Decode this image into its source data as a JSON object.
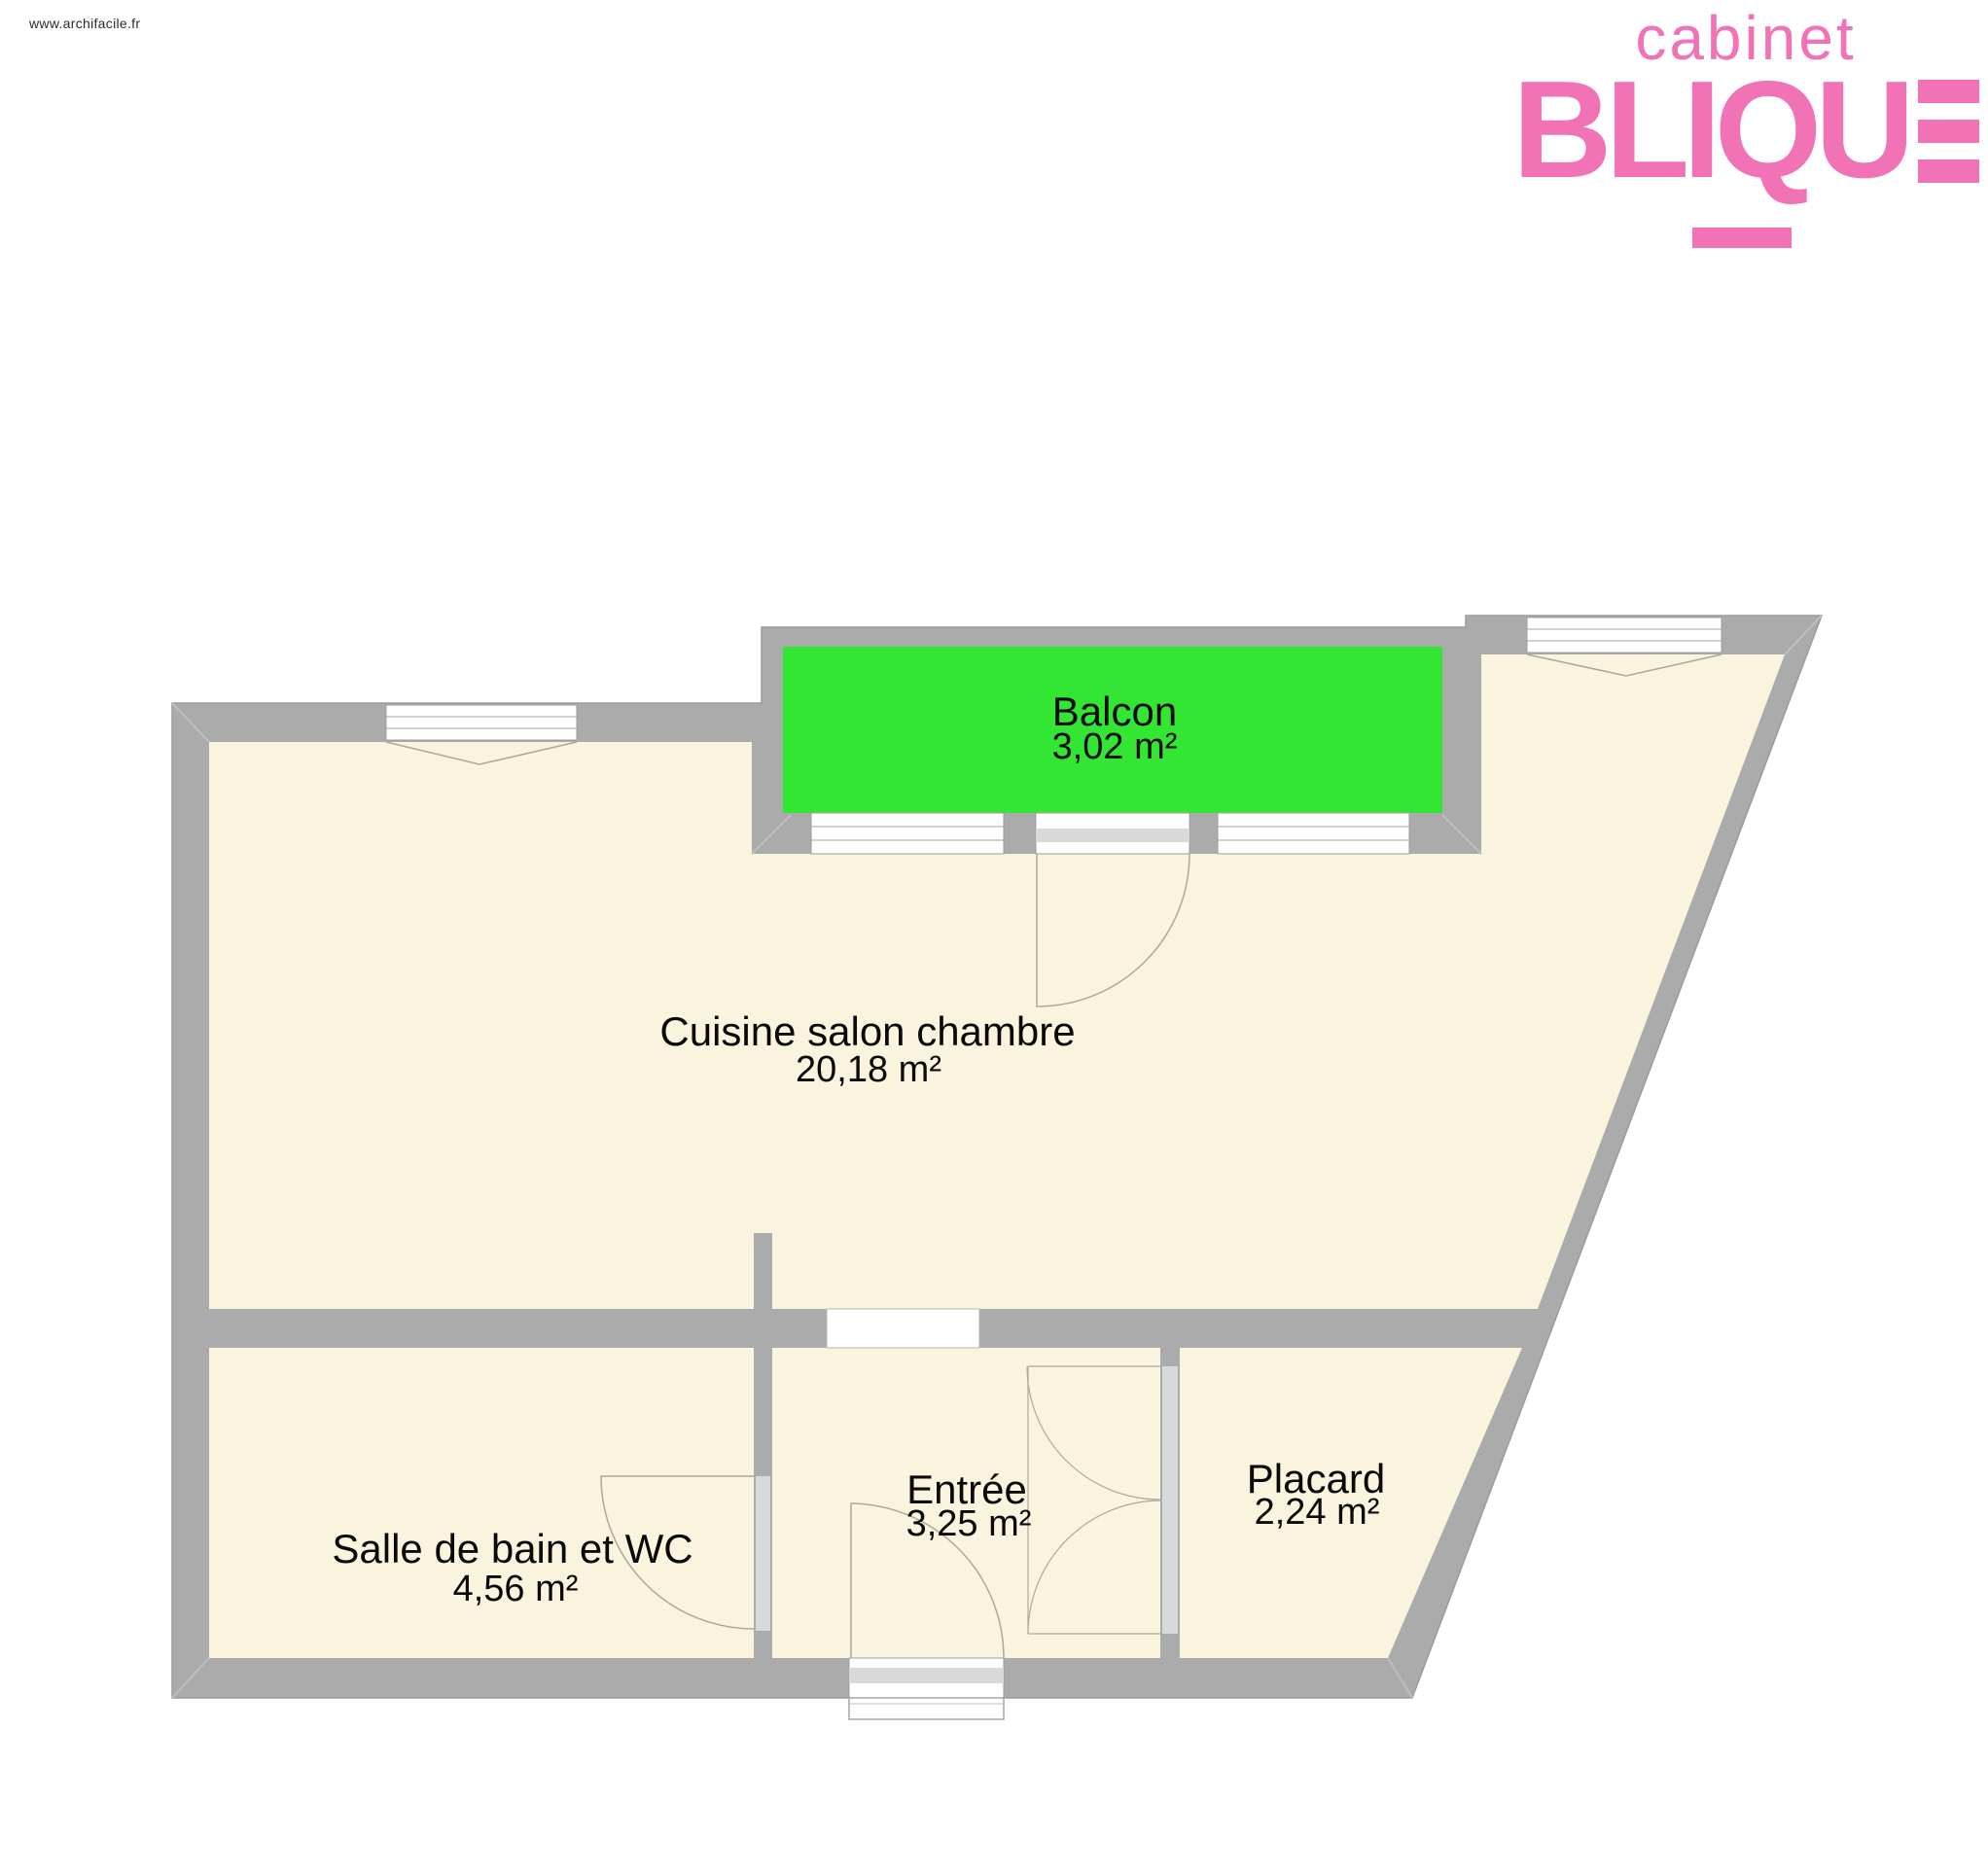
{
  "watermark": "www.archifacile.fr",
  "logo": {
    "line1": "cabinet",
    "line2_letters": "BLIQU",
    "color": "#F173B5"
  },
  "plan": {
    "rooms": [
      {
        "name": "Balcon",
        "area": "3,02 m²"
      },
      {
        "name": "Cuisine salon chambre",
        "area": "20,18 m²"
      },
      {
        "name": "Salle de bain et WC",
        "area": "4,56 m²"
      },
      {
        "name": "Entrée",
        "area": "3,25 m²"
      },
      {
        "name": "Placard",
        "area": "2,24 m²"
      }
    ],
    "colors": {
      "wall": "#ABABAB",
      "room_fill": "#FAF3DD",
      "balcony_fill": "#33E633",
      "door_leaf": "#D9D9D9",
      "logo_pink": "#F173B5"
    }
  }
}
